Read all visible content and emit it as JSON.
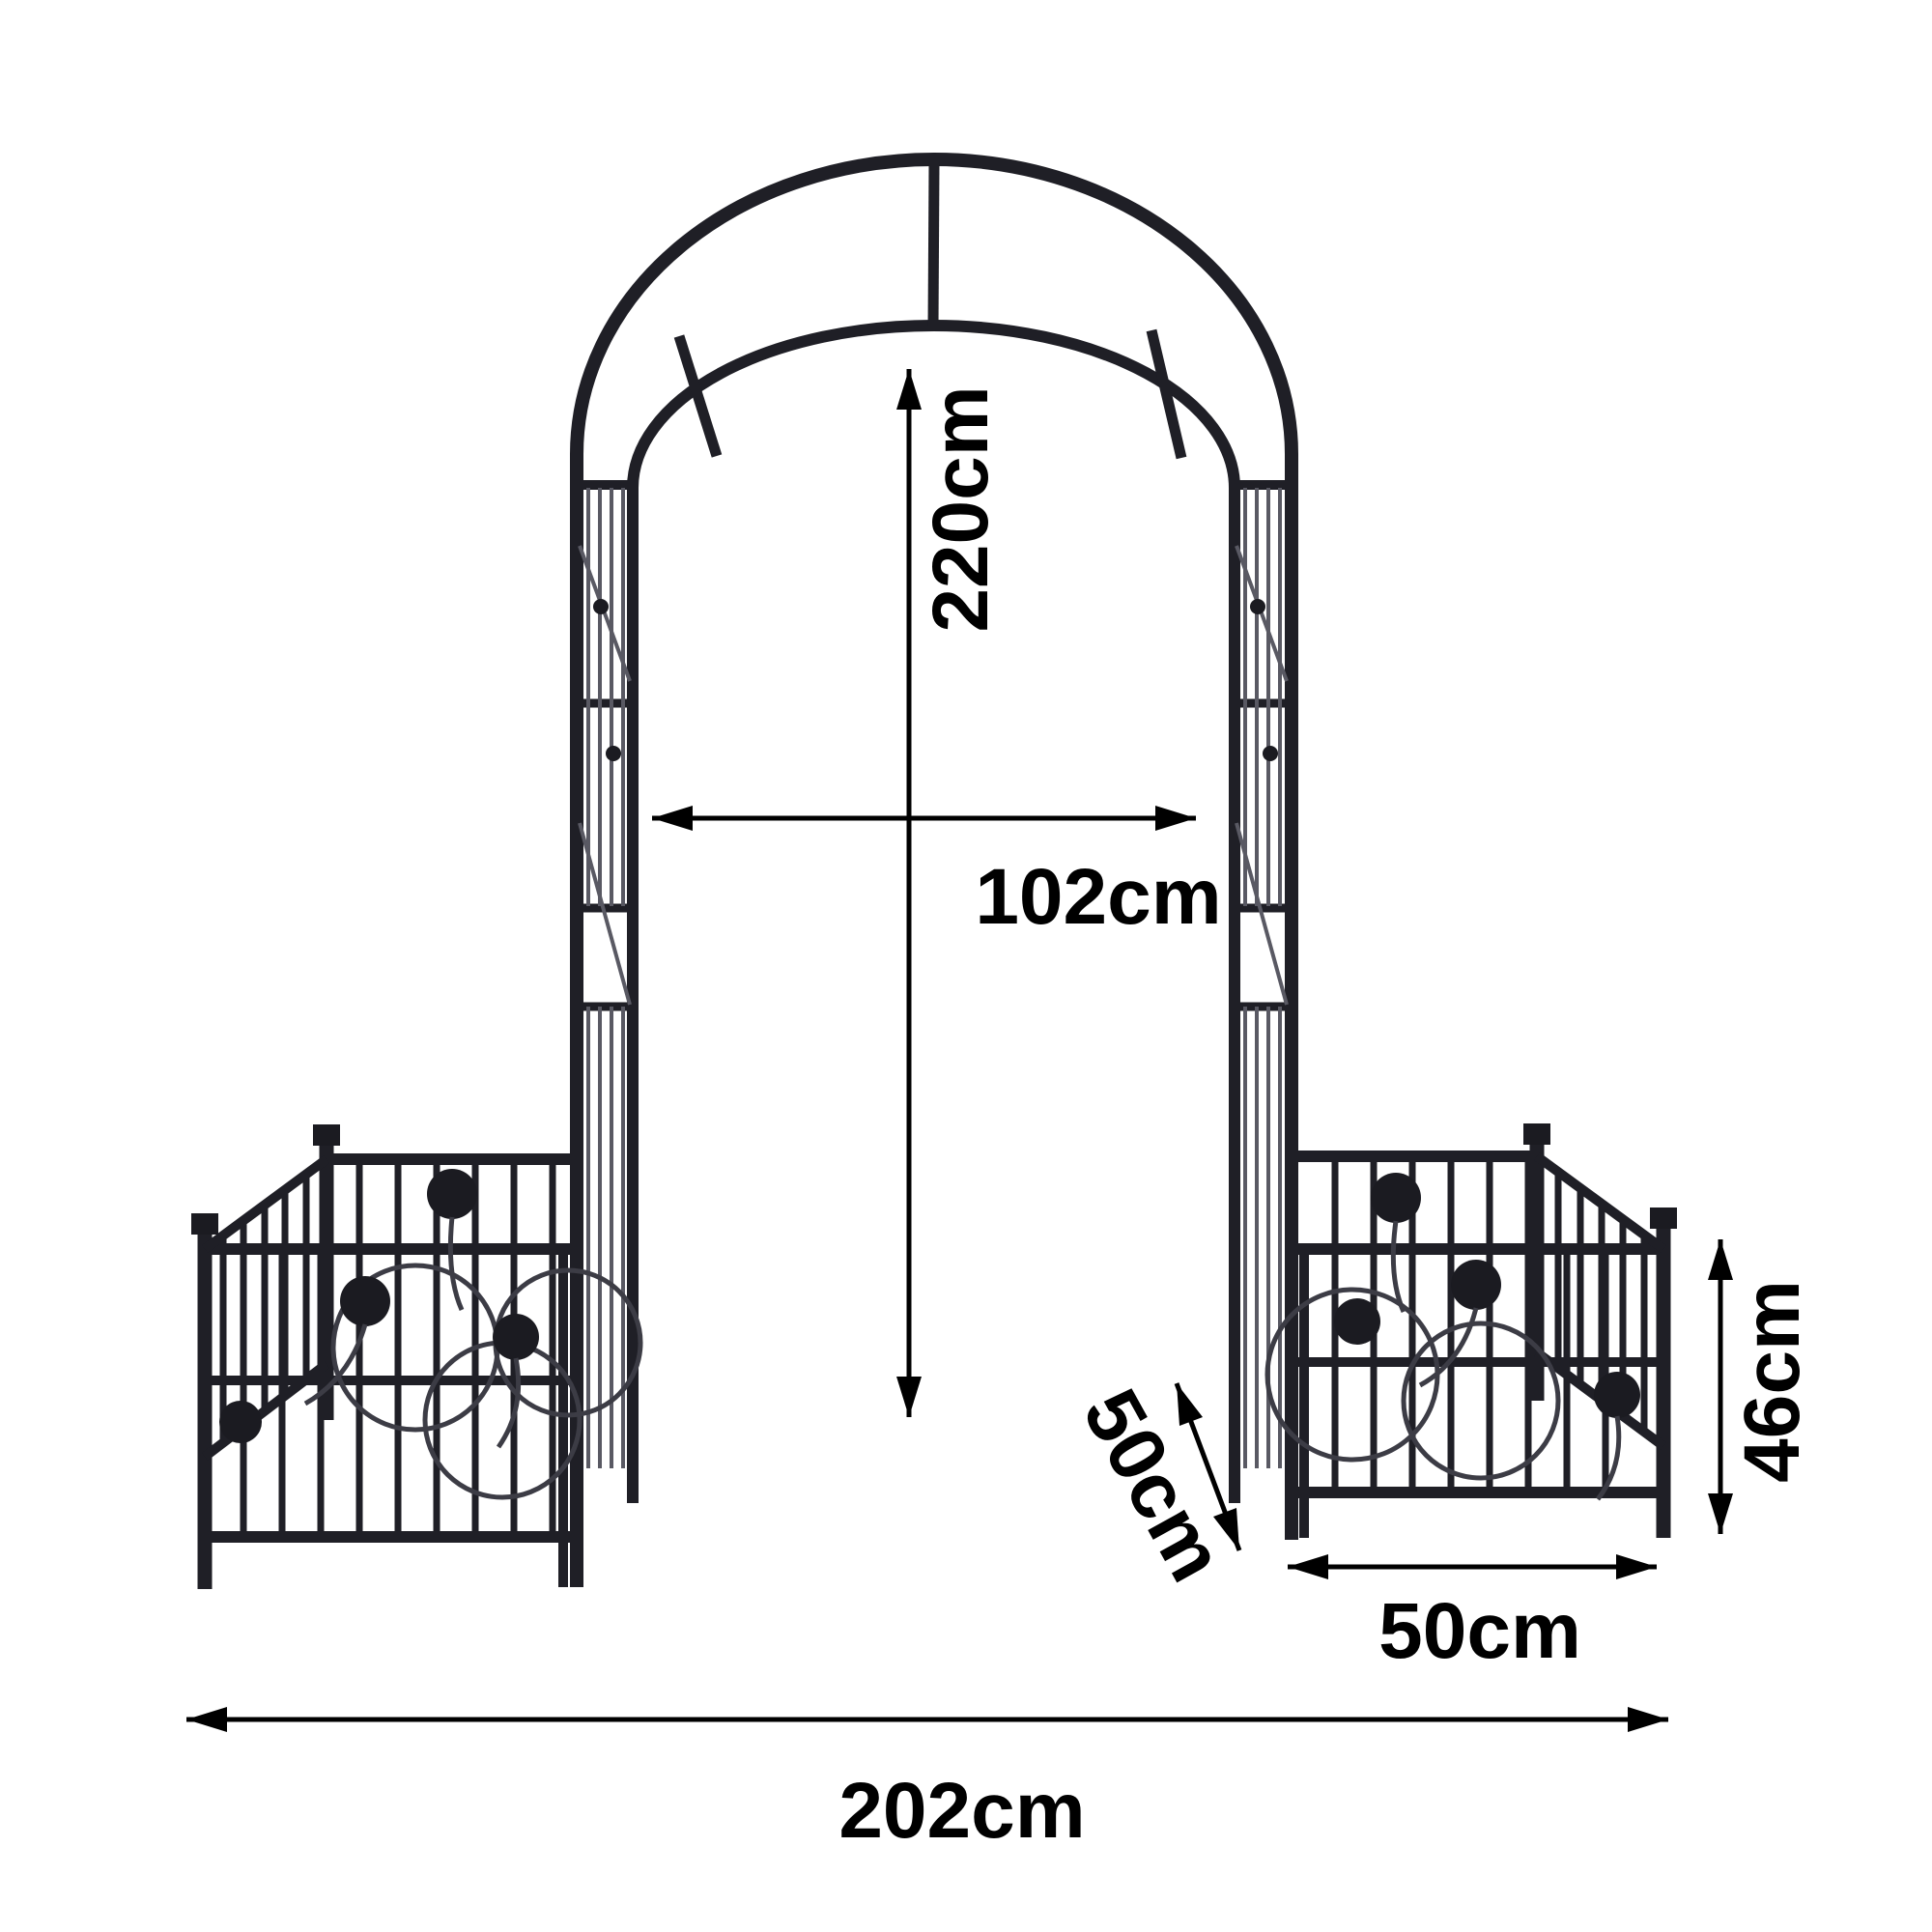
{
  "diagram": {
    "background_color": "#ffffff",
    "ironwork_color": "#1f1f26",
    "annotation_color": "#000000",
    "labels": {
      "arch_height": "220cm",
      "arch_inner_width": "102cm",
      "planter_depth": "50cm",
      "planter_height": "46cm",
      "planter_width": "50cm",
      "total_width": "202cm"
    }
  }
}
